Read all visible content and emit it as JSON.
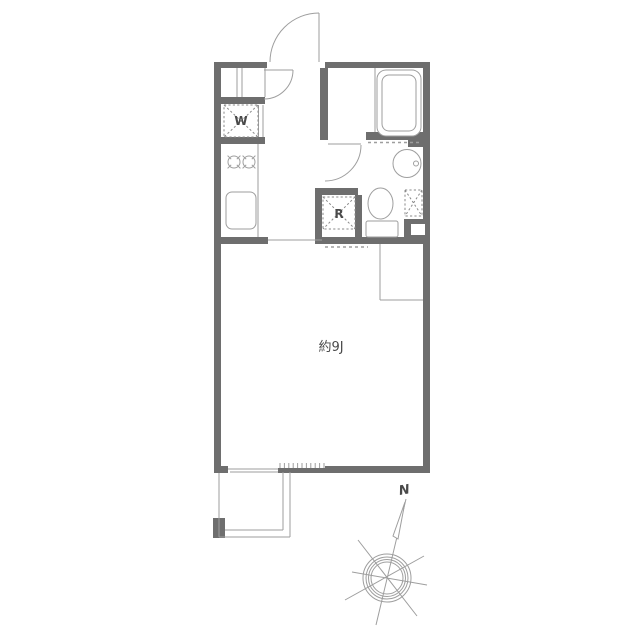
{
  "floor_plan": {
    "room_label": "約9J",
    "washing_machine_label": "W",
    "refrigerator_label": "R",
    "compass_label": "N"
  },
  "colors": {
    "wall": "#6e6e6e",
    "line": "#9e9e9e",
    "dash": "#8a8a8a",
    "text": "#4a4a4a",
    "background": "#ffffff"
  }
}
